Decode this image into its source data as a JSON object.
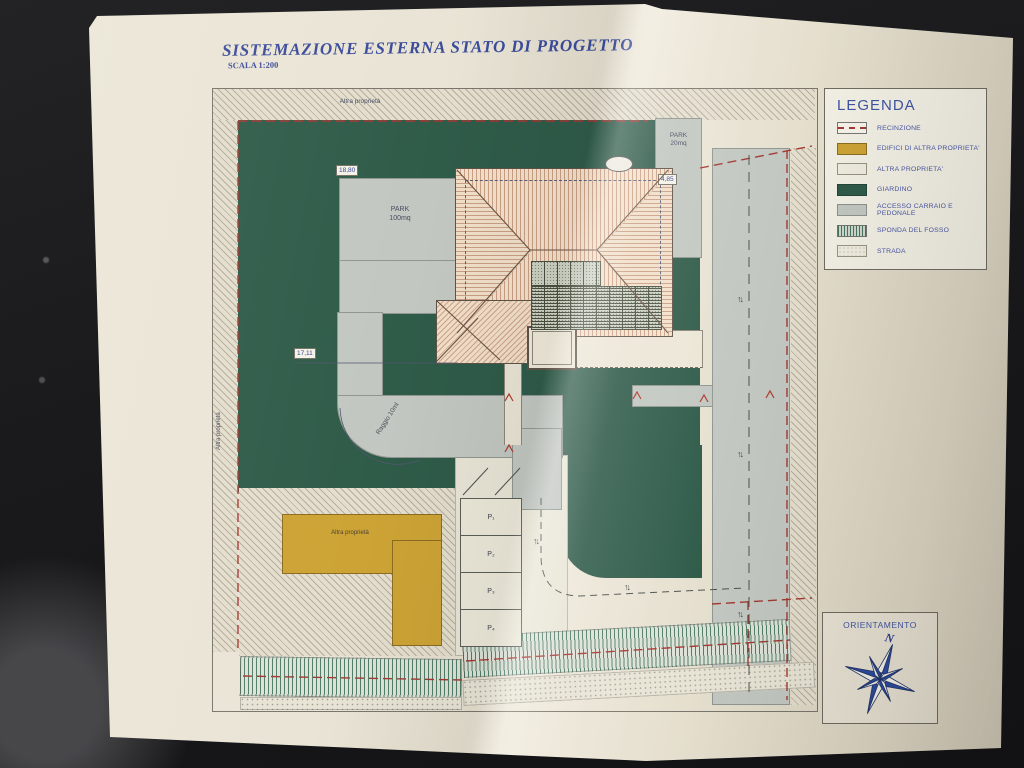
{
  "title": {
    "main": "SISTEMAZIONE ESTERNA STATO DI PROGETTO",
    "scale": "SCALA 1:200"
  },
  "plan": {
    "labels": {
      "other_property_top": "Altra proprietà",
      "other_property_left": "Altra proprietà",
      "other_property_building": "Altra proprietà",
      "park_large_1": "PARK",
      "park_large_2": "100mq",
      "park_small_1": "PARK",
      "park_small_2": "20mq",
      "radius_note": "Raggio 10ml"
    },
    "dimensions": {
      "top_left": "18,80",
      "mid_left": "17,11",
      "park_small": "4,85"
    },
    "parking_stalls": [
      "P₁",
      "P₂",
      "P₃",
      "P₄"
    ],
    "traffic_arrows": "↑↓"
  },
  "legend": {
    "title": "LEGENDA",
    "items": [
      {
        "label": "RECINZIONE"
      },
      {
        "label": "EDIFICI DI ALTRA PROPRIETA'"
      },
      {
        "label": "ALTRA PROPRIETA'"
      },
      {
        "label": "GIARDINO"
      },
      {
        "label": "ACCESSO CARRAIO E PEDONALE"
      },
      {
        "label": "SPONDA DEL FOSSO"
      },
      {
        "label": "STRADA"
      }
    ]
  },
  "orientation": {
    "title": "ORIENTAMENTO",
    "north": "N"
  },
  "colors": {
    "paper": "#e8e2d2",
    "ink_blue": "#3b4c9b",
    "garden_green": "#2f5b49",
    "access_gray": "#c2c7c1",
    "other_building_gold": "#cda335",
    "fence_red": "#a23a32",
    "roof": "#f3e1cb"
  }
}
